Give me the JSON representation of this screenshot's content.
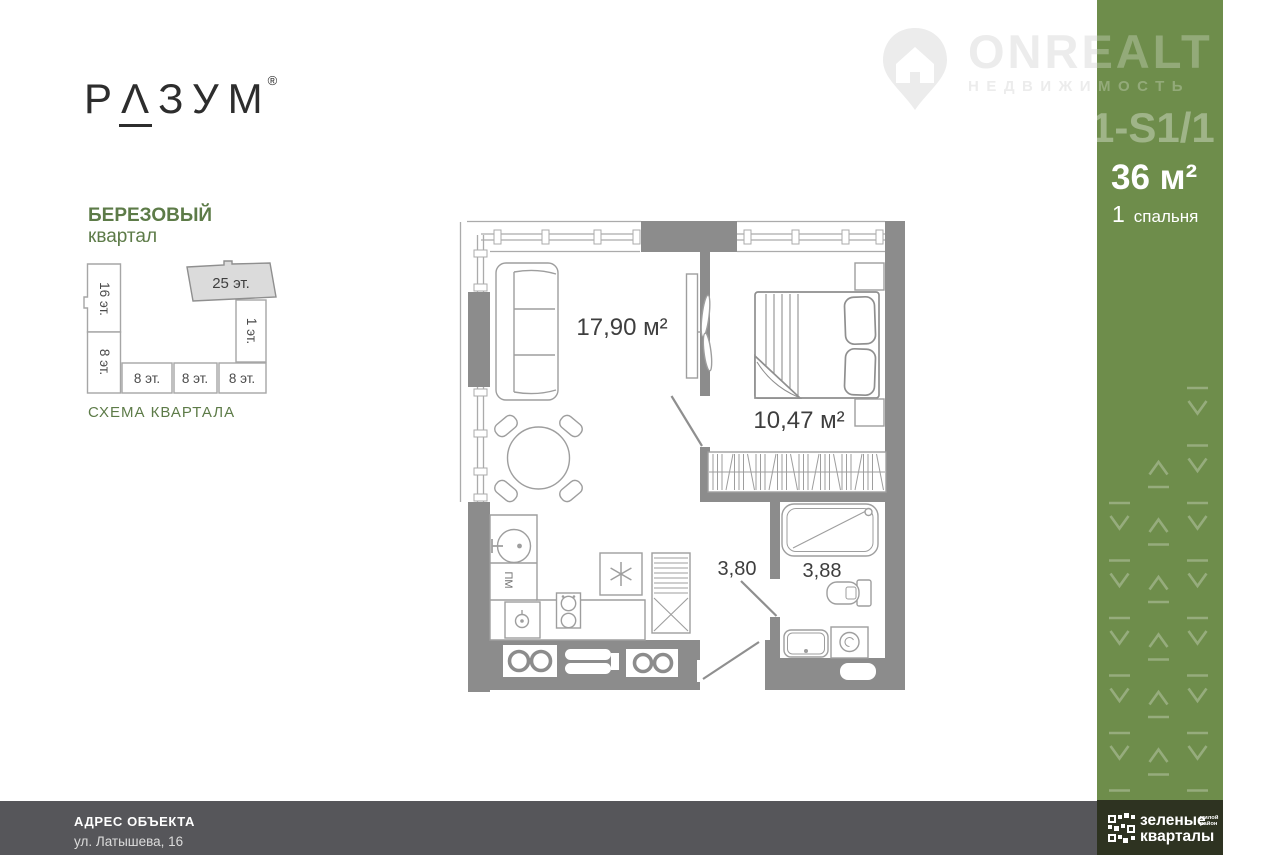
{
  "brand_logo": {
    "p1": "Р",
    "p2": "Λ",
    "p3": "ЗУМ",
    "reg": "®"
  },
  "district": {
    "line1": "БЕРЕЗОВЫЙ",
    "line2": "квартал",
    "caption": "СХЕМА КВАРТАЛА",
    "accent_color": "#5d7b48"
  },
  "schema_blocks": {
    "b16": "16 эт.",
    "b8a": "8 эт.",
    "b8b": "8 эт.",
    "b8c": "8 эт.",
    "b8d": "8 эт.",
    "b1": "1 эт.",
    "b25": "25 эт."
  },
  "watermark": {
    "brand": "ONREALT",
    "sub": "НЕДВИЖИМОСТЬ"
  },
  "panel": {
    "bg_color": "#6e8d4b",
    "code": "1-S1/1",
    "area": "36 м²",
    "rooms_num": "1",
    "rooms_label": "спальня"
  },
  "plan": {
    "living_area": "17,90 м²",
    "bedroom_area": "10,47 м²",
    "hall_area": "3,80",
    "bath_area": "3,88",
    "dishwasher_label": "ПМ"
  },
  "footer": {
    "bar_color": "#56565a",
    "address_label": "АДРЕС ОБЪЕКТА",
    "address_value": "ул. Латышева, 16"
  },
  "developer": {
    "block_color": "#2e3321",
    "line1": "зеленые",
    "line2": "кварталы",
    "tag_line1": "жилой",
    "tag_line2": "район"
  }
}
